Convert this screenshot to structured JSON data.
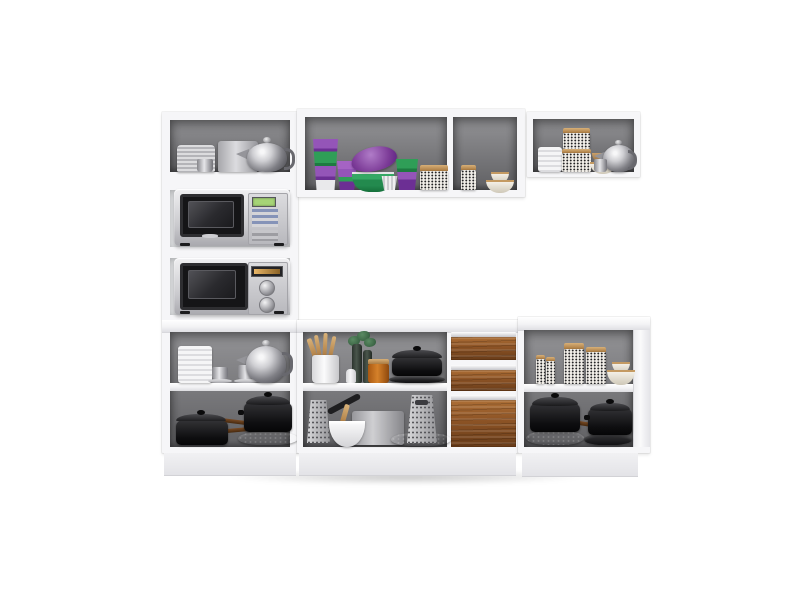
{
  "scene": {
    "description": "White modular kitchen cabinet set on a white background: tall left tower holding two silver microwaves, wall cabinets with colorful cups, bowls and patterned jars, and base cabinets with three wood drawers, graters, utensils and black cookware",
    "regions": {
      "tower": {
        "label": "tall left cabinet tower with open shelves and two microwave niches"
      },
      "wall_cabinet_center": {
        "label": "center wall cabinet with two open sections"
      },
      "wall_cabinet_right": {
        "label": "right wall cabinet"
      },
      "base_center": {
        "label": "center base cabinet with open shelves and 3 wood drawers"
      },
      "base_right": {
        "label": "right base cabinet with open shelves"
      }
    },
    "counts": {
      "microwaves": 2,
      "wood_drawers": 3
    },
    "items": {
      "tower_top": [
        "stacked gray plates",
        "gray canister",
        "espresso cups",
        "stainless teapot"
      ],
      "tower_microwaves": [
        "silver microwave with green display and keypad",
        "silver microwave with amber display and two dials"
      ],
      "base_left_shelf": [
        "white ribbed canister",
        "chrome espresso cups with saucers",
        "stainless teapot"
      ],
      "base_left_lower": [
        "black casserole with lid",
        "stacked black pots and roasting pan",
        "wood-handled pans"
      ],
      "wall_center_left": [
        "green and purple tumbler stacks",
        "purple bowl",
        "green bowl stack",
        "white fluted cup",
        "black-and-white patterned tin"
      ],
      "wall_center_right": [
        "patterned spice jar",
        "cream bowl stack"
      ],
      "wall_right": [
        "white cup stack",
        "patterned canisters",
        "tan bowl",
        "cream bowl",
        "stainless teapot",
        "chrome creamer"
      ],
      "base_center_shelf": [
        "crock with wooden utensils",
        "herb bottles",
        "salt shaker",
        "amber jar",
        "black roaster"
      ],
      "base_center_lower": [
        "box grater",
        "white mixing bowl with spoon",
        "gray saucepan",
        "large box grater",
        "frying pan"
      ],
      "base_right_shelf": [
        "small patterned jars",
        "tall patterned jars",
        "cream bowl stack"
      ],
      "base_right_lower": [
        "stacked black pots",
        "black pot with lid"
      ]
    }
  },
  "colors": {
    "bg": "#ffffff",
    "frame": "#f6f6f8",
    "frameEdge": "#d8d8dc",
    "interior": "#7c7c7f",
    "interiorDark": "#606063",
    "interiorLight": "#939396",
    "board": "#f1f1f3",
    "wood": "#8f5526",
    "woodLight": "#ad6f36",
    "woodDark": "#693c19",
    "chrome": "#c9c9cd",
    "blackware": "#18181a",
    "green": "#2f9e57",
    "greenDeep": "#1e7a41",
    "purple": "#9455b8",
    "purpleDeep": "#6c2f94",
    "cream": "#ece7db",
    "tan": "#c49a62",
    "jar": "#f1eee8",
    "amber": "#c2691d",
    "displayGreen": "#a6d477",
    "displayAmber": "#e8b668"
  }
}
